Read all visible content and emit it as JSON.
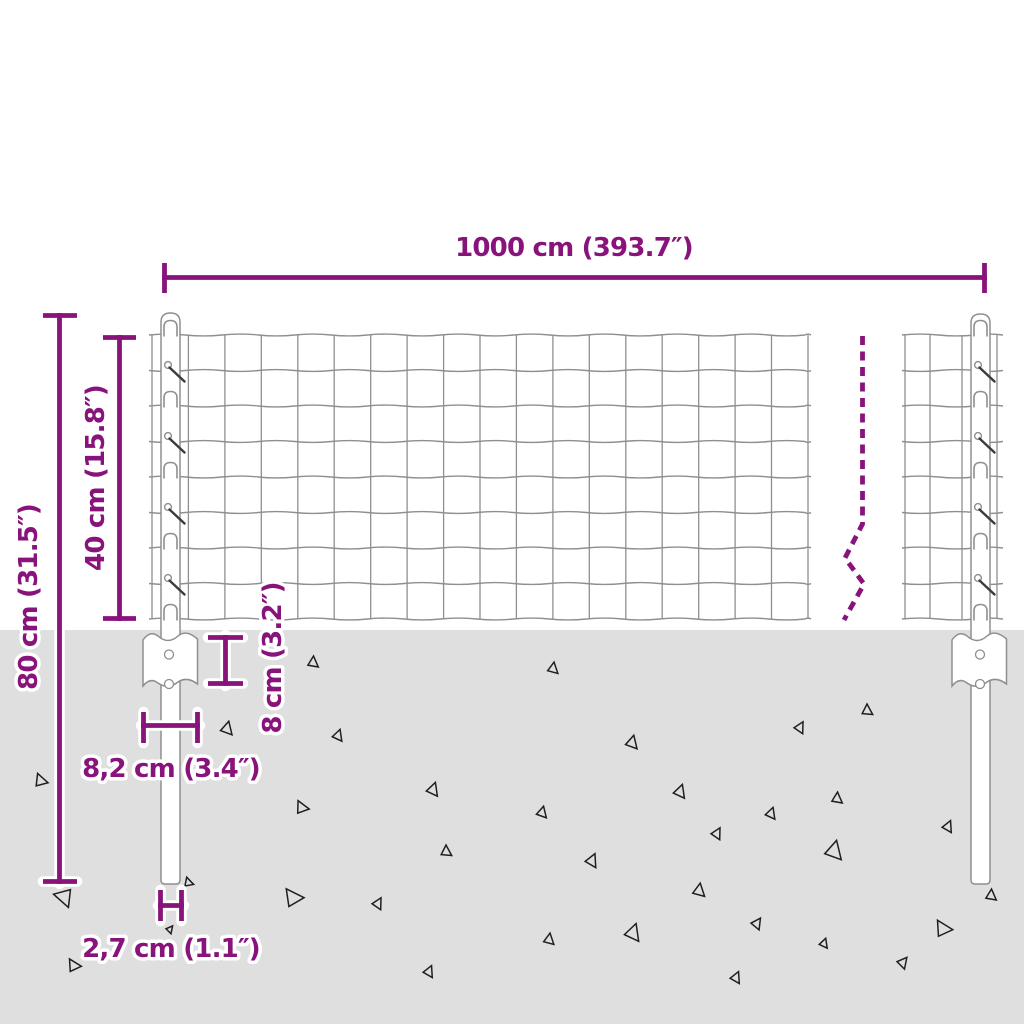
{
  "colors": {
    "accent": "#87137b",
    "ground": "#dfdfdf",
    "wire": "#8f8f8f",
    "background": "#ffffff"
  },
  "labels": {
    "total_width": "1000 cm (393.7″)",
    "post_height": "80 cm (31.5″)",
    "mesh_height": "40 cm (15.8″)",
    "plate_depth": "8 cm (3.2″)",
    "plate_width": "8,2 cm (3.4″)",
    "post_diameter": "2,7 cm (1.1″)"
  }
}
